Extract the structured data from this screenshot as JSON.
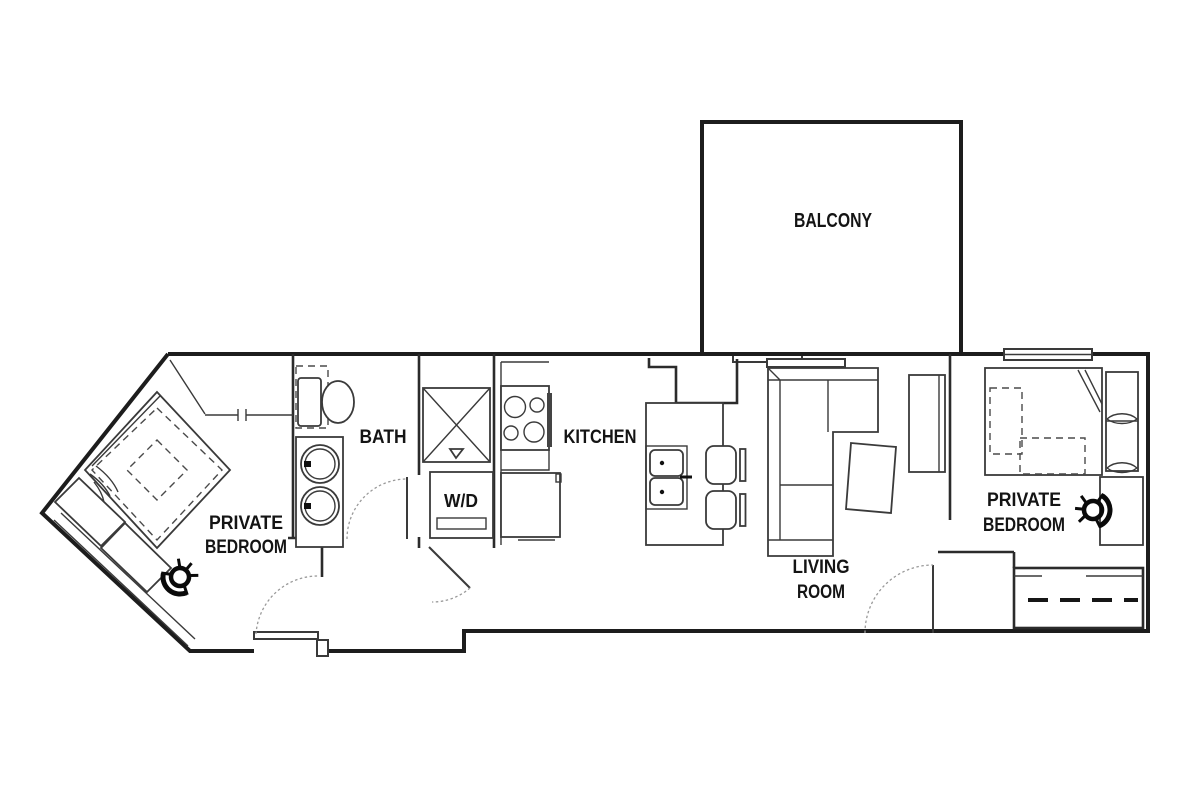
{
  "plan_type": "apartment-floor-plan",
  "rooms": {
    "balcony": {
      "label": "BALCONY"
    },
    "bedroom_left": {
      "line1": "PRIVATE",
      "line2": "BEDROOM"
    },
    "bath": {
      "label": "BATH"
    },
    "laundry": {
      "label": "W/D"
    },
    "kitchen": {
      "label": "KITCHEN"
    },
    "living_room": {
      "line1": "LIVING",
      "line2": "ROOM"
    },
    "bedroom_right": {
      "line1": "PRIVATE",
      "line2": "BEDROOM"
    }
  },
  "fixtures": [
    "toilet",
    "double-sink-vanity",
    "shower",
    "washer-dryer",
    "range",
    "refrigerator",
    "island-sink",
    "bar-stool",
    "bar-stool",
    "sectional-sofa",
    "coffee-table",
    "tv-console",
    "bed",
    "bed",
    "desk",
    "task-chair",
    "task-chair",
    "closet-rod",
    "door-swing",
    "window",
    "sliding-balcony-door"
  ],
  "colors": {
    "background": "#ffffff",
    "wall_ink": "#1d1d1d",
    "furniture_ink": "#3a3a3a",
    "door_arc": "#9a9a9a"
  }
}
